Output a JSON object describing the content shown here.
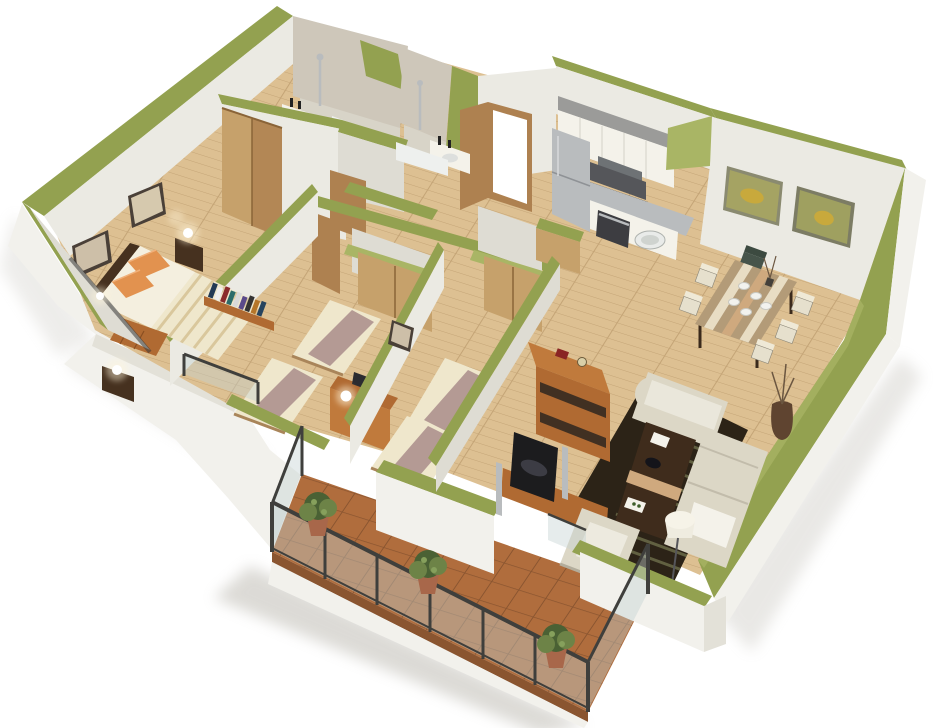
{
  "canvas": {
    "width": 940,
    "height": 728
  },
  "scene": {
    "type": "isometric-3d-floor-plan-render",
    "rooms": [
      {
        "id": "master-bedroom",
        "furniture": [
          "double-bed",
          "orange-pillows",
          "wardrobe",
          "nightstand",
          "table-lamp",
          "wall-sconce",
          "wall-art",
          "book-shelf",
          "low-dresser"
        ]
      },
      {
        "id": "bathroom-1",
        "furniture": [
          "shower-column",
          "sink-counter",
          "bathtub",
          "door"
        ]
      },
      {
        "id": "bathroom-2",
        "furniture": [
          "shower-column",
          "sink-counter",
          "bathtub"
        ]
      },
      {
        "id": "entrance-hall",
        "furniture": [
          "front-door",
          "open-door-leaf",
          "closet-room",
          "closet-room"
        ]
      },
      {
        "id": "kitchen",
        "furniture": [
          "refrigerator",
          "upper-cabinets",
          "range-hood",
          "cooktop",
          "oven",
          "base-cabinets",
          "round-sink"
        ]
      },
      {
        "id": "dining-room",
        "furniture": [
          "dining-table",
          "striped-runner",
          "plates",
          "centerpiece",
          "dining-chairs",
          "wall-art",
          "wall-art"
        ]
      },
      {
        "id": "bedroom-2",
        "furniture": [
          "single-bed",
          "single-bed",
          "desk",
          "laptop",
          "desk-lamp",
          "juliet-railing"
        ]
      },
      {
        "id": "bedroom-3",
        "furniture": [
          "single-bed",
          "single-bed",
          "wall-art",
          "closet"
        ]
      },
      {
        "id": "living-room",
        "furniture": [
          "chaise-sofa",
          "sofa",
          "white-throw",
          "armchair",
          "coffee-table",
          "striped-rug",
          "tv-screen",
          "tv-cabinet",
          "speaker-columns",
          "bookshelf",
          "floor-lamp",
          "twig-vase"
        ]
      },
      {
        "id": "balcony",
        "furniture": [
          "glass-railing",
          "potted-plant",
          "potted-plant",
          "potted-plant",
          "terracotta-tiles"
        ]
      }
    ]
  },
  "palette": {
    "background": "#ffffff",
    "wall_top_green": "#93a150",
    "wall_top_green_light": "#a9b565",
    "wall_face_light": "#ebeae3",
    "wall_face_mid": "#dedcd3",
    "wall_face_shaded": "#cfcdc3",
    "wall_exterior": "#f2f1ec",
    "wall_exterior_shade": "#e3e1d8",
    "tiled_wall": "#cec7ba",
    "tile_line": "#bdb5a6",
    "wood_floor": "#ddc092",
    "wood_floor_line": "#c4a476",
    "bath_floor": "#d8d4c8",
    "balcony_tile": "#b06d3d",
    "balcony_tile_line": "#8a5530",
    "closet_wood": "#c6a16b",
    "door_wood": "#ae8150",
    "furniture_dark": "#46311f",
    "shelf_orange": "#b06a32",
    "shelf_orange_light": "#c07a3c",
    "bed_cream": "#efe7cc",
    "bed_stripe": "#d9c79c",
    "duvet_white": "#f4efdf",
    "throw_mauve": "#b49a94",
    "pillow_orange": "#e2924f",
    "sofa_cream": "#dcd7c6",
    "cushion_white": "#f4f2ea",
    "rug_dark": "#2c2317",
    "rug_stripe": "#6c6c49",
    "metal_silver": "#b9bcbe",
    "metal_dark": "#6e7275",
    "appliance_gray": "#9b9b99",
    "railing_dark": "#3f3f3c",
    "glass_tint": "rgba(195,210,210,0.42)",
    "lamp_glow": "#fff6dc",
    "plant_green": "#4a6134",
    "plant_green_light": "#6d8347",
    "pot_terracotta": "#a8674a",
    "art_olive": "#a5a363",
    "art_yellow": "#c8a93c",
    "table_wood": "#b39b78",
    "runner_cream": "#e8ddc4",
    "runner_tan": "#cfa97e",
    "plate_white": "#f2f2ee",
    "frame_dark": "#4a4038",
    "shadow_gray": "#b2afa5"
  }
}
